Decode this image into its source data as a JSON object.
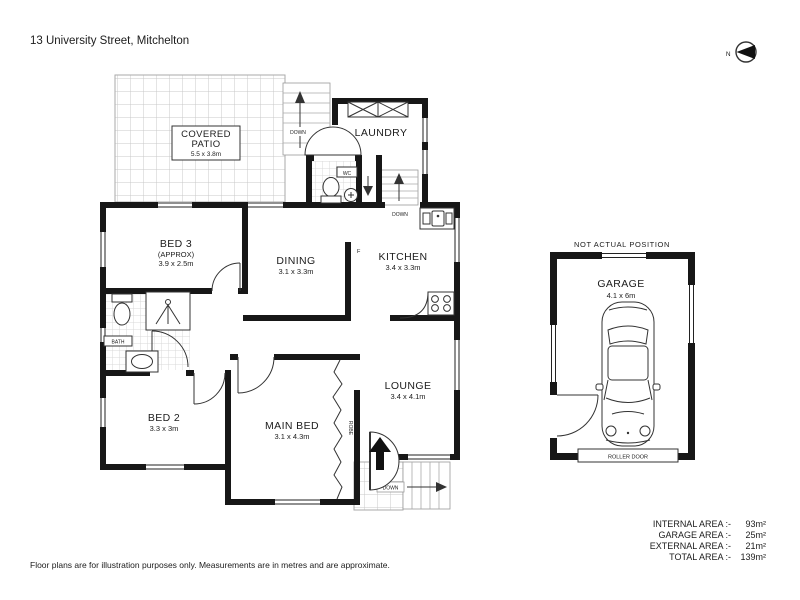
{
  "page": {
    "title": "13 University Street, Mitchelton",
    "compass": {
      "label": "N"
    },
    "disclaimer": "Floor plans are for illustration purposes only. Measurements are in metres and are approximate."
  },
  "rooms": {
    "patio": {
      "line1": "COVERED",
      "line2": "PATIO",
      "dims": "5.5 x 3.8m"
    },
    "laundry": {
      "name": "LAUNDRY"
    },
    "wc": {
      "name": "WC"
    },
    "bed3": {
      "name": "BED 3",
      "note": "(APPROX)",
      "dims": "3.9 x 2.5m"
    },
    "dining": {
      "name": "DINING",
      "dims": "3.1 x 3.3m"
    },
    "kitchen": {
      "name": "KITCHEN",
      "dims": "3.4 x 3.3m"
    },
    "bath": {
      "name": "BATH"
    },
    "bed2": {
      "name": "BED 2",
      "dims": "3.3 x 3m"
    },
    "main_bed": {
      "name": "MAIN BED",
      "dims": "3.1 x 4.3m"
    },
    "lounge": {
      "name": "LOUNGE",
      "dims": "3.4 x 4.1m"
    },
    "garage": {
      "name": "GARAGE",
      "dims": "4.1 x 6m"
    }
  },
  "annotations": {
    "down_top_steps": "DOWN",
    "down_internal_stairs": "DOWN",
    "down_front_steps": "DOWN",
    "robe": "ROBE",
    "fridge": "F",
    "not_actual_position": "NOT ACTUAL POSITION",
    "roller_door": "ROLLER DOOR"
  },
  "areas": {
    "rows": [
      {
        "label": "INTERNAL AREA :-",
        "value": "93m²"
      },
      {
        "label": "GARAGE AREA :-",
        "value": "25m²"
      },
      {
        "label": "EXTERNAL AREA :-",
        "value": "21m²"
      },
      {
        "label": "TOTAL AREA :-",
        "value": "139m²"
      }
    ]
  }
}
